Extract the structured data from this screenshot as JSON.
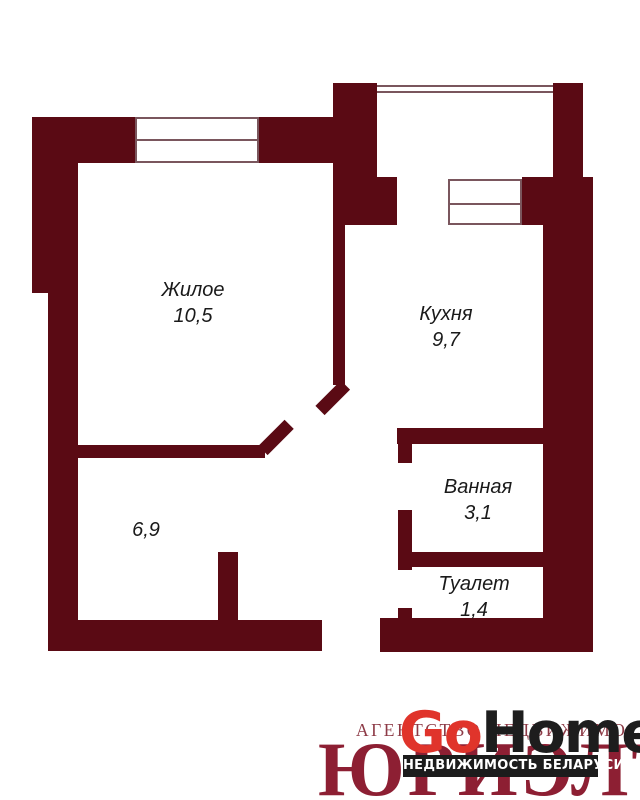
{
  "colors": {
    "wall": "#5a0a14",
    "window_line": "#7a565d",
    "label_text": "#1a1a1a",
    "logo_red": "#e0342b",
    "logo_black": "#1d1d1d",
    "watermark_red": "#8d1f33",
    "watermark_light": "#8d3a46",
    "bar_bg": "#1c1c1c",
    "bar_text": "#ffffff"
  },
  "rooms": [
    {
      "id": "living",
      "name": "Жилое",
      "area": "10,5"
    },
    {
      "id": "kitchen",
      "name": "Кухня",
      "area": "9,7"
    },
    {
      "id": "bathroom",
      "name": "Ванная",
      "area": "3,1"
    },
    {
      "id": "toilet",
      "name": "Туалет",
      "area": "1,4"
    },
    {
      "id": "hallway",
      "name": "",
      "area": "6,9"
    }
  ],
  "logo": {
    "brand_first": "Go",
    "brand_second": "Home",
    "tagline": "НЕДВИЖИМОСТЬ БЕЛАРУСИ",
    "watermark_top": "АГЕНТСТВО НЕДВИЖИМОСТИ",
    "watermark_main": "ЮРИЭЛТ"
  }
}
